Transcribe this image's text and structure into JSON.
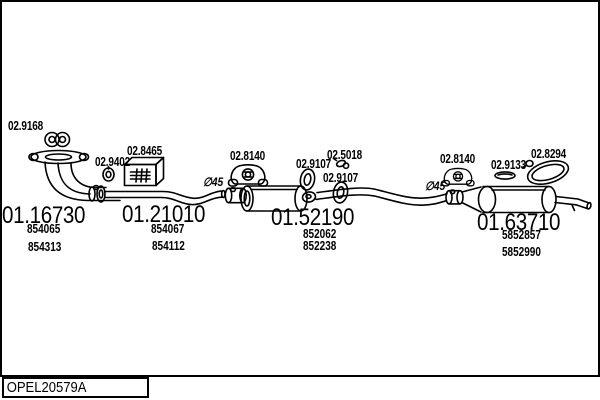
{
  "colors": {
    "ink": "#000000",
    "background": "#ffffff"
  },
  "diagram": {
    "annotations": [
      {
        "text": "∅45"
      },
      {
        "text": "∅45"
      }
    ],
    "accessories": [
      {
        "number": "02.9168",
        "icon": "double-ring-clamp-icon"
      },
      {
        "number": "02.9402",
        "icon": "ring-clamp-icon"
      },
      {
        "number": "02.8465",
        "icon": "mounting-box-icon"
      },
      {
        "number": "02.8140",
        "icon": "rubber-hanger-icon"
      },
      {
        "number": "02.9107",
        "icon": "gasket-ring-icon"
      },
      {
        "number": "02.5018",
        "icon": "pipe-clamp-icon"
      },
      {
        "number": "02.9107",
        "icon": "gasket-ring-icon"
      },
      {
        "number": "02.8140",
        "icon": "rubber-hanger-icon"
      },
      {
        "number": "02.9133",
        "icon": "flat-gasket-icon"
      },
      {
        "number": "02.8294",
        "icon": "band-clamp-icon"
      }
    ],
    "groups": [
      {
        "number": "01.16730",
        "oe_refs": [
          "854065",
          "854313"
        ]
      },
      {
        "number": "01.21010",
        "oe_refs": [
          "854067",
          "854112"
        ]
      },
      {
        "number": "01.52190",
        "oe_refs": [
          "852062",
          "852238"
        ]
      },
      {
        "number": "01.63710",
        "oe_refs": [
          "5852857",
          "5852990"
        ]
      }
    ]
  },
  "footer": {
    "code": "OPEL20579A"
  }
}
